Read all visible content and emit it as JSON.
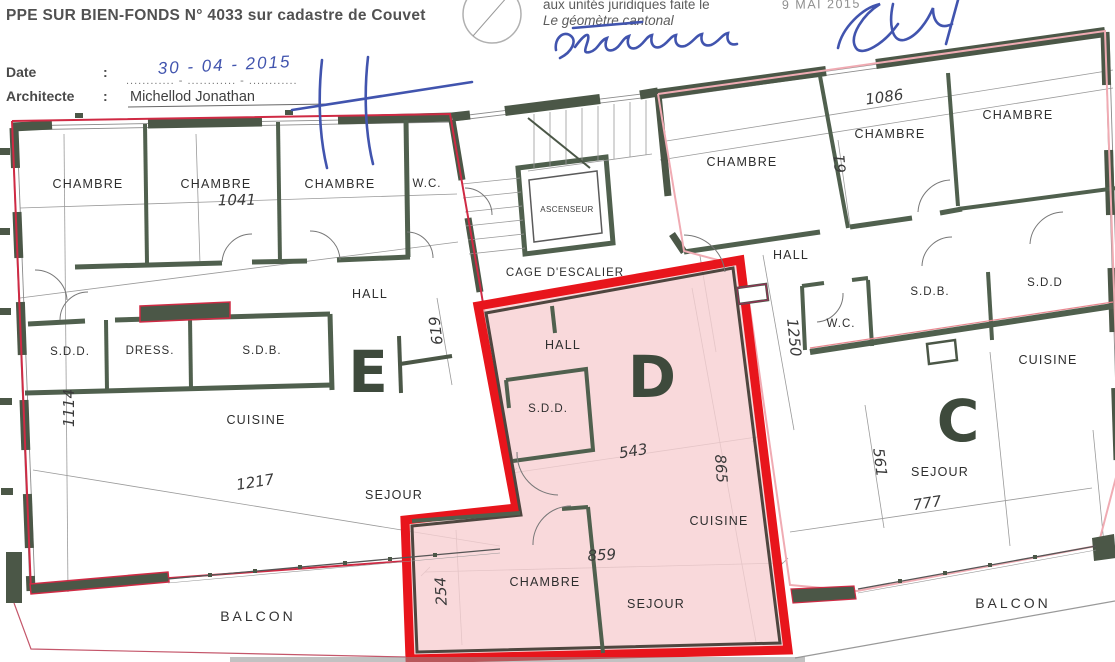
{
  "header": {
    "title": "PPE SUR BIEN-FONDS N° 4033 sur cadastre de Couvet",
    "date_label": "Date",
    "colon": ":",
    "date_value_handwritten": "30 - 04 - 2015",
    "date_dotted_line": "............ - ............ - ............",
    "architect_label": "Architecte",
    "architect_name": "Michellod Jonathan"
  },
  "certification": {
    "line1": "aux unités juridiques faite le",
    "stamp_date": "9 MAI 2015",
    "line2": "Le géomètre cantonal"
  },
  "plan": {
    "units": {
      "e": "E",
      "d": "D",
      "c": "C"
    },
    "rooms": {
      "e_chambre1": "CHAMBRE",
      "e_chambre2": "CHAMBRE",
      "e_chambre3": "CHAMBRE",
      "e_wc": "W.C.",
      "e_hall": "HALL",
      "e_sdd": "S.D.D.",
      "e_dress": "DRESS.",
      "e_sdb": "S.D.B.",
      "e_cuisine": "CUISINE",
      "e_sejour": "SEJOUR",
      "d_hall": "HALL",
      "d_sdd": "S.D.D.",
      "d_cuisine": "CUISINE",
      "d_chambre": "CHAMBRE",
      "d_sejour": "SEJOUR",
      "c_chambre1": "CHAMBRE",
      "c_chambre2": "CHAMBRE",
      "c_chambre3": "CHAMBRE",
      "c_hall": "HALL",
      "c_wc": "W.C.",
      "c_sdb": "S.D.B.",
      "c_sdd": "S.D.D",
      "c_cuisine": "CUISINE",
      "c_sejour": "SEJOUR",
      "stairs": "CAGE D'ESCALIER",
      "elevator": "ASCENSEUR",
      "balcony_left": "BALCON",
      "balcony_right": "BALCON"
    },
    "dims": {
      "e_top": "1041",
      "e_left": "1114",
      "e_sejour_w": "1217",
      "e_stair": "619",
      "d_hall_w": "543",
      "d_right": "865",
      "d_width": "859",
      "d_chambre_h": "254",
      "c_top": "1086",
      "c_mid": "61",
      "c_hall": "1250",
      "c_sejour_h": "561",
      "c_sejour_w": "777"
    }
  },
  "colors": {
    "wall": "#4b5747",
    "wall_int": "#50604e",
    "unit_d_border": "#e8151c",
    "unit_d_fill": "#f7cfd2",
    "unit_e_outline": "#cf2a44",
    "unit_c_outline": "#f0abb3",
    "signature_blue": "#4154ae",
    "label_text": "#2e2e2e"
  }
}
